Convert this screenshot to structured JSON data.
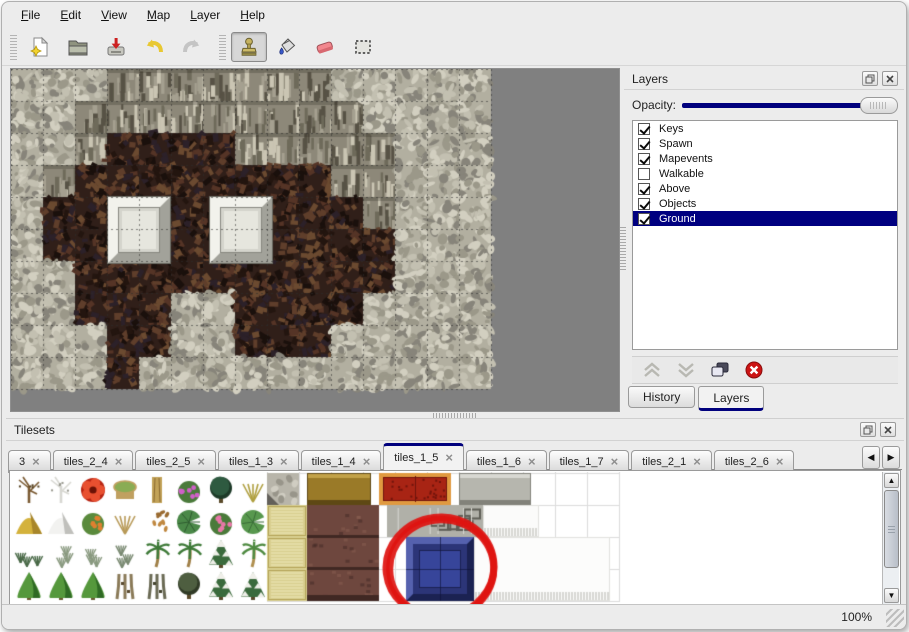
{
  "menu": {
    "items": [
      "File",
      "Edit",
      "View",
      "Map",
      "Layer",
      "Help"
    ]
  },
  "toolbar": {
    "buttons": [
      {
        "name": "new-file",
        "group": 1
      },
      {
        "name": "open-file",
        "group": 1
      },
      {
        "name": "save-file",
        "group": 1
      },
      {
        "name": "undo",
        "group": 1
      },
      {
        "name": "redo",
        "group": 1
      },
      {
        "name": "stamp-tool",
        "group": 2,
        "active": true
      },
      {
        "name": "fill-tool",
        "group": 2
      },
      {
        "name": "eraser-tool",
        "group": 2
      },
      {
        "name": "select-tool",
        "group": 2
      }
    ]
  },
  "map_editor": {
    "tile_size": 32,
    "grid": [
      "SSSCCCCCCCSSSSS",
      "SSCCCCCCCCCSSSS",
      "SSCFFFFCCCCCSSS",
      "SCFFFFFFFFCCSSS",
      "SFFFFFFFFFFCSSS",
      "SFFFFFFFFFFFSSS",
      "SSFFFFFFFFFFSSS",
      "SSFFFSSFFFFSSSS",
      "SSSFFSSFFFSSSSS",
      "SSSFSSSSSSSSSSS"
    ],
    "pillars": [
      {
        "x": 97,
        "y": 128,
        "w": 62,
        "h": 66
      },
      {
        "x": 199,
        "y": 128,
        "w": 62,
        "h": 66
      }
    ],
    "base_colors": {
      "bg": "#808080",
      "S": "#b2afa0",
      "C": "#8d8879",
      "F": "#301f19"
    },
    "texture_palettes": {
      "S": [
        "#d2cfc0",
        "#9b9889",
        "#c3c0b1",
        "#87847a"
      ],
      "C": [
        "#575245",
        "#cac5b3",
        "#6e6a5a",
        "#a5a090"
      ],
      "F": [
        "#553426",
        "#23150f",
        "#5f3e2b",
        "#2c2129",
        "#6b4a30",
        "#1a100c"
      ]
    }
  },
  "layers_panel": {
    "title": "Layers",
    "opacity_label": "Opacity:",
    "opacity_value_fraction": 1,
    "layers": [
      {
        "name": "Keys",
        "checked": true,
        "selected": false
      },
      {
        "name": "Spawn",
        "checked": true,
        "selected": false
      },
      {
        "name": "Mapevents",
        "checked": true,
        "selected": false
      },
      {
        "name": "Walkable",
        "checked": false,
        "selected": false
      },
      {
        "name": "Above",
        "checked": true,
        "selected": false
      },
      {
        "name": "Objects",
        "checked": true,
        "selected": false
      },
      {
        "name": "Ground",
        "checked": true,
        "selected": true
      }
    ],
    "buttons": [
      "move-layer-up",
      "move-layer-down",
      "duplicate-layer",
      "delete-layer"
    ],
    "tabs": [
      {
        "label": "History",
        "active": false
      },
      {
        "label": "Layers",
        "active": true
      }
    ]
  },
  "tilesets_panel": {
    "title": "Tilesets",
    "tabs": [
      {
        "label": "3",
        "active": false
      },
      {
        "label": "tiles_2_4",
        "active": false
      },
      {
        "label": "tiles_2_5",
        "active": false
      },
      {
        "label": "tiles_1_3",
        "active": false
      },
      {
        "label": "tiles_1_4",
        "active": false
      },
      {
        "label": "tiles_1_5",
        "active": true
      },
      {
        "label": "tiles_1_6",
        "active": false
      },
      {
        "label": "tiles_1_7",
        "active": false
      },
      {
        "label": "tiles_2_1",
        "active": false
      },
      {
        "label": "tiles_2_6",
        "active": false
      }
    ],
    "palette": {
      "tiles": [
        {
          "x": 2,
          "y": 2,
          "kind": "branches",
          "colors": [
            "#7a5a32",
            "#55401f"
          ]
        },
        {
          "x": 34,
          "y": 2,
          "kind": "branches",
          "colors": [
            "#d8d8d2",
            "#98988e"
          ]
        },
        {
          "x": 66,
          "y": 2,
          "kind": "bigflower",
          "colors": [
            "#b82412",
            "#e85030",
            "#6a1206"
          ]
        },
        {
          "x": 98,
          "y": 2,
          "kind": "stump",
          "colors": [
            "#8aac54",
            "#c0a060"
          ]
        },
        {
          "x": 130,
          "y": 2,
          "kind": "trunk",
          "colors": [
            "#c2a258",
            "#8a6a30"
          ]
        },
        {
          "x": 162,
          "y": 2,
          "kind": "dotbush",
          "colors": [
            "#4a7a3a",
            "#d060c8"
          ]
        },
        {
          "x": 194,
          "y": 2,
          "kind": "canopy",
          "colors": [
            "#2e5a40",
            "#1d3a28"
          ]
        },
        {
          "x": 226,
          "y": 2,
          "kind": "sprigs",
          "colors": [
            "#b0a040"
          ]
        },
        {
          "x": 2,
          "y": 34,
          "kind": "mound",
          "colors": [
            "#d4b23c",
            "#a8862a"
          ]
        },
        {
          "x": 34,
          "y": 34,
          "kind": "mound",
          "colors": [
            "#f2f2f0",
            "#c0c0bc"
          ]
        },
        {
          "x": 66,
          "y": 34,
          "kind": "dotbush",
          "colors": [
            "#5a8a3c",
            "#e08030"
          ]
        },
        {
          "x": 98,
          "y": 34,
          "kind": "sprigs",
          "colors": [
            "#b89a58"
          ]
        },
        {
          "x": 130,
          "y": 34,
          "kind": "scatter",
          "colors": [
            "#9a6a30",
            "#c08840"
          ]
        },
        {
          "x": 162,
          "y": 34,
          "kind": "lily",
          "colors": [
            "#4a8848",
            "#2f5c30"
          ]
        },
        {
          "x": 194,
          "y": 34,
          "kind": "dotbush",
          "colors": [
            "#4a7a3a",
            "#e878a8"
          ]
        },
        {
          "x": 226,
          "y": 34,
          "kind": "lily",
          "colors": [
            "#58984e",
            "#3a6c38"
          ]
        },
        {
          "x": 2,
          "y": 66,
          "kind": "tufts",
          "colors": [
            "#4a6a48"
          ]
        },
        {
          "x": 34,
          "y": 66,
          "kind": "tufts",
          "colors": [
            "#8a9a80"
          ]
        },
        {
          "x": 66,
          "y": 66,
          "kind": "tufts",
          "colors": [
            "#8a9a80"
          ]
        },
        {
          "x": 98,
          "y": 66,
          "kind": "tufts",
          "colors": [
            "#7a8a72"
          ]
        },
        {
          "x": 130,
          "y": 66,
          "kind": "palm",
          "colors": [
            "#3e7a38",
            "#a08048"
          ]
        },
        {
          "x": 162,
          "y": 66,
          "kind": "palm",
          "colors": [
            "#3e7a38",
            "#a08048"
          ]
        },
        {
          "x": 194,
          "y": 66,
          "kind": "pinesnow",
          "colors": [
            "#3a6a3c",
            "#efefe9"
          ]
        },
        {
          "x": 226,
          "y": 66,
          "kind": "palm",
          "colors": [
            "#4e8a40",
            "#b09050"
          ]
        },
        {
          "x": 2,
          "y": 98,
          "kind": "conifer",
          "colors": [
            "#55983c",
            "#2f6a24"
          ]
        },
        {
          "x": 34,
          "y": 98,
          "kind": "conifer",
          "colors": [
            "#55983c",
            "#2f6a24"
          ]
        },
        {
          "x": 66,
          "y": 98,
          "kind": "conifer",
          "colors": [
            "#55983c",
            "#2f6a24"
          ]
        },
        {
          "x": 98,
          "y": 98,
          "kind": "twist",
          "colors": [
            "#8a7a58",
            "#5a4a30"
          ]
        },
        {
          "x": 130,
          "y": 98,
          "kind": "twist",
          "colors": [
            "#6a6a54",
            "#44442f"
          ]
        },
        {
          "x": 162,
          "y": 98,
          "kind": "canopy",
          "colors": [
            "#4e5e40",
            "#303a26"
          ]
        },
        {
          "x": 194,
          "y": 98,
          "kind": "pinesnow",
          "colors": [
            "#3a6a3c",
            "#efefe9"
          ]
        },
        {
          "x": 226,
          "y": 98,
          "kind": "pinesnow",
          "colors": [
            "#3a6a3c",
            "#efefe9"
          ]
        },
        {
          "x": 256,
          "y": 1,
          "w": 32,
          "h": 32,
          "kind": "cobble",
          "colors": [
            "#b8b5aa",
            "#63605a"
          ]
        },
        {
          "x": 256,
          "y": 33,
          "w": 40,
          "h": 32,
          "kind": "tatami",
          "colors": [
            "#d9cf90",
            "#b4a458",
            "#efe7b8"
          ]
        },
        {
          "x": 256,
          "y": 65,
          "w": 40,
          "h": 32,
          "kind": "tatami",
          "colors": [
            "#d9cf90",
            "#b4a458",
            "#efe7b8"
          ]
        },
        {
          "x": 256,
          "y": 97,
          "w": 40,
          "h": 32,
          "kind": "tatami",
          "colors": [
            "#d9cf90",
            "#b4a458",
            "#efe7b8"
          ]
        },
        {
          "x": 296,
          "y": 1,
          "w": 64,
          "h": 32,
          "kind": "flat",
          "colors": [
            "#9a7a28",
            "#5e4814",
            "#c2a248"
          ]
        },
        {
          "x": 296,
          "y": 33,
          "w": 72,
          "h": 96,
          "kind": "maroon",
          "colors": [
            "#6e473e",
            "#402823",
            "#8a5f52"
          ]
        },
        {
          "x": 368,
          "y": 1,
          "w": 72,
          "h": 32,
          "kind": "carpet",
          "colors": [
            "#a82414",
            "#e09a40",
            "#70140c"
          ]
        },
        {
          "x": 448,
          "y": 1,
          "w": 72,
          "h": 32,
          "kind": "flat",
          "colors": [
            "#b6b6ae",
            "#82827a",
            "#d8d8d2"
          ]
        },
        {
          "x": 376,
          "y": 33,
          "w": 96,
          "h": 32,
          "kind": "blocks",
          "colors": [
            "#b0b0a8",
            "#5f5f57",
            "#dadad4"
          ]
        },
        {
          "x": 472,
          "y": 33,
          "w": 56,
          "h": 32,
          "kind": "fringe",
          "colors": [
            "#fbfbfa",
            "#b4b4ae"
          ]
        },
        {
          "x": 395,
          "y": 65,
          "w": 68,
          "h": 64,
          "kind": "bluebevel",
          "colors": [
            "#2c3578",
            "#5561ae",
            "#37459a",
            "#1b2252"
          ]
        },
        {
          "x": 463,
          "y": 65,
          "w": 136,
          "h": 64,
          "kind": "fringe",
          "colors": [
            "#fcfcfb",
            "#b4b4ae"
          ]
        }
      ],
      "annotation_circle": {
        "cx": 429,
        "cy": 95,
        "rx": 54,
        "ry": 50,
        "color": "#de1410"
      }
    }
  },
  "status_bar": {
    "zoom": "100%"
  },
  "colors": {
    "accent": "#00007d",
    "selection": "#000080",
    "panel_bg": "#ececec",
    "canvas_bg": "#808080"
  }
}
